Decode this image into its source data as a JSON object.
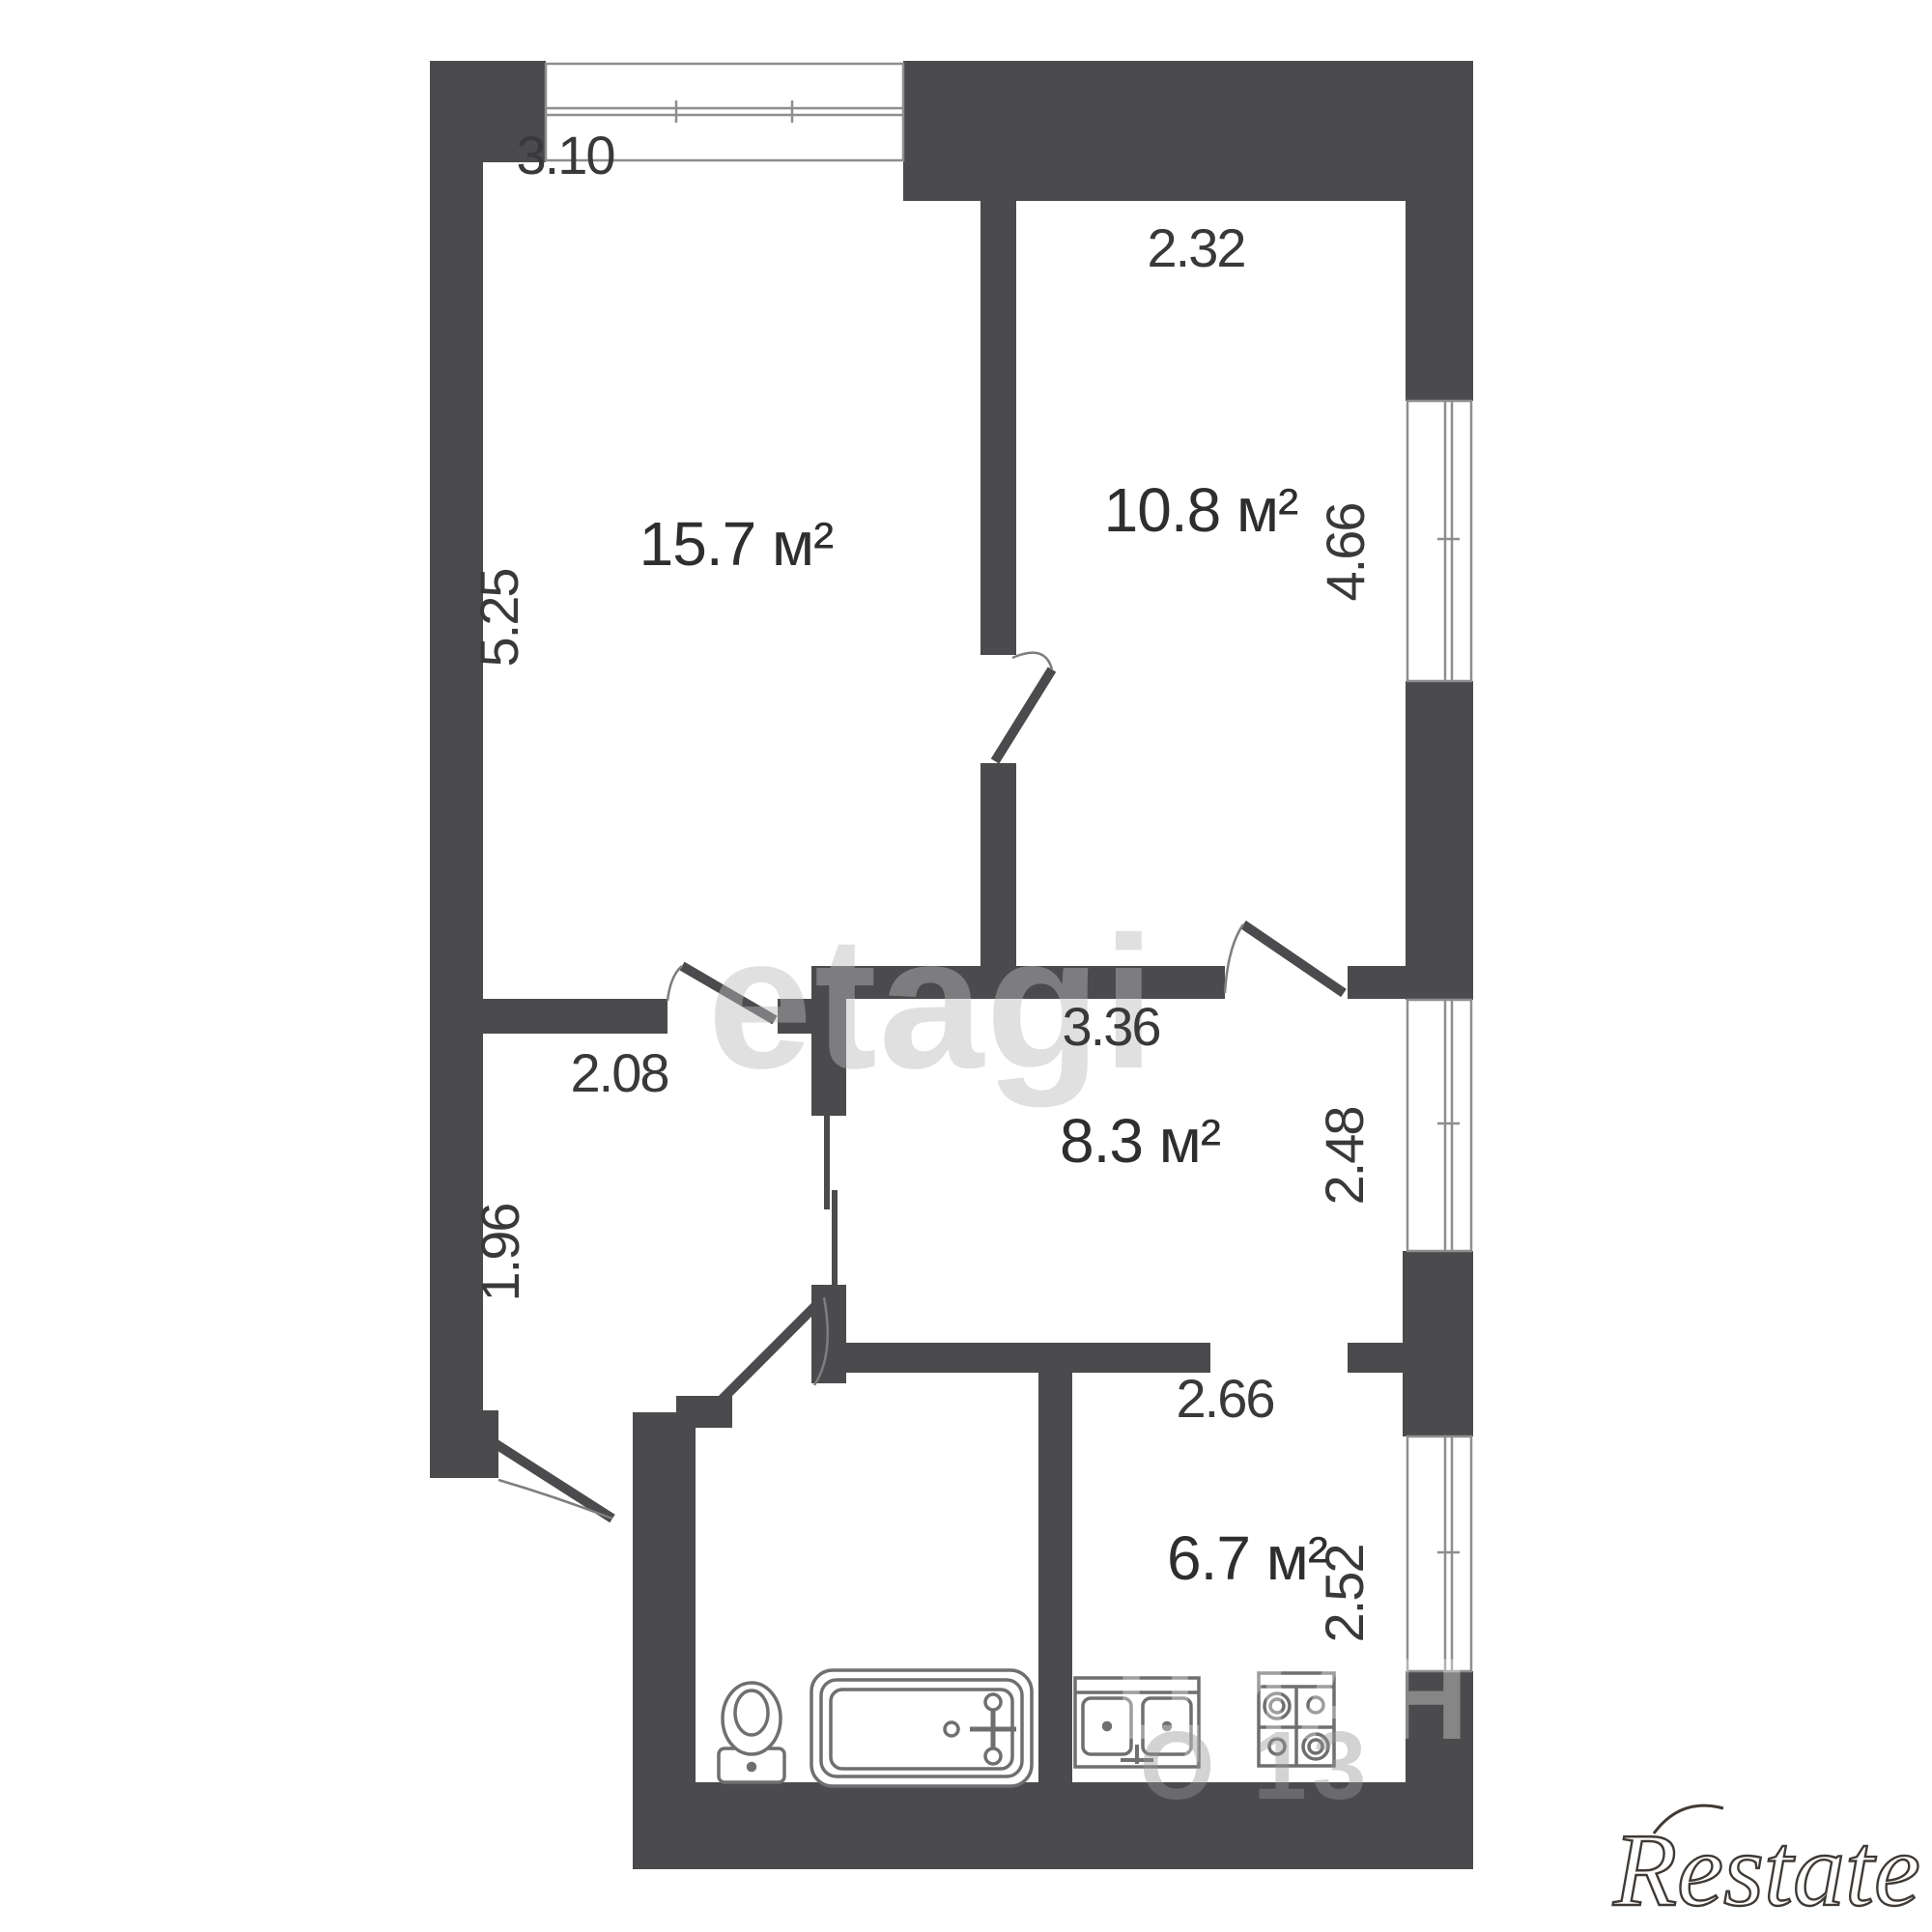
{
  "plan_title": "2-room apartment floor plan",
  "wall_color": "#4b4b4d",
  "rooms": [
    {
      "name": "living-room",
      "area": "15.7 м²",
      "width": "3.10",
      "depth": "5.25"
    },
    {
      "name": "bedroom",
      "area": "10.8 м²",
      "width": "2.32",
      "depth": "4.66"
    },
    {
      "name": "hall-room",
      "area": "8.3 м²",
      "width": "3.36",
      "depth": "2.48"
    },
    {
      "name": "kitchen",
      "area": "6.7 м²",
      "width": "2.66",
      "depth": "2.52"
    },
    {
      "name": "corridor",
      "width": "2.08",
      "depth": "1.96"
    }
  ],
  "watermarks": {
    "center": "etagi",
    "portal": "ЦИАН",
    "portal_fragment": "О 13",
    "agency": "Restate"
  }
}
